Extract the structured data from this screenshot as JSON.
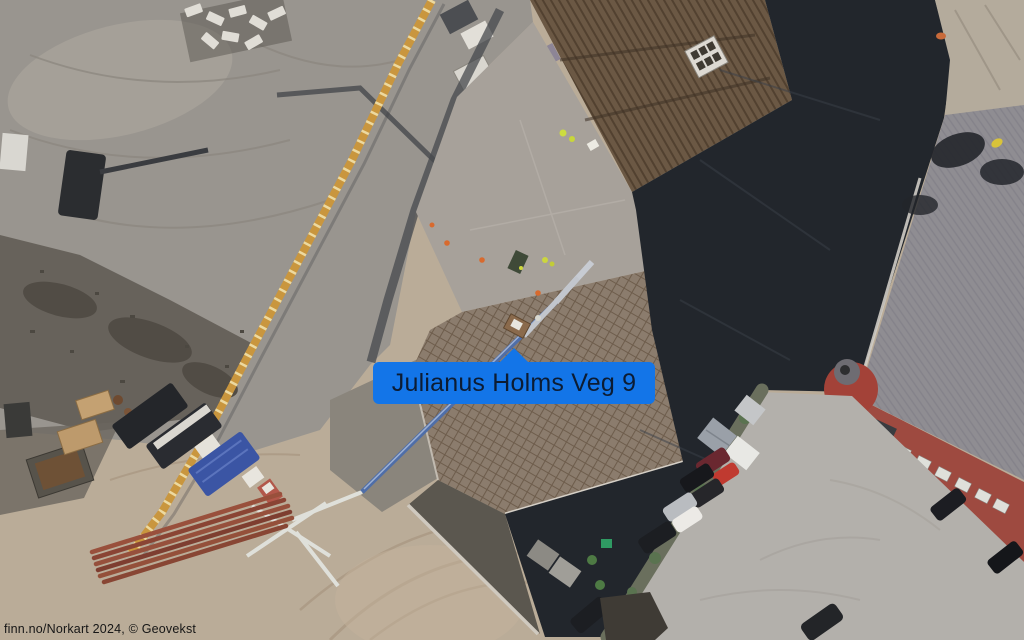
{
  "map": {
    "label": {
      "text": "Julianus Holms Veg 9",
      "bg_color": "#1375e8",
      "text_color": "#0c1c33"
    },
    "attribution": {
      "text": "finn.no/Norkart 2024, © Geovekst"
    }
  },
  "colors": {
    "dirt": "#baac98",
    "excavation": "#99958f",
    "dark_shadow": "#22262c",
    "concrete_deck": "#a7a19a",
    "rebar_deck": "#8b7c6d",
    "wood_roof": "#6b5844",
    "rock_area": "#b4ab9c",
    "red_building_wall": "#9e4a40",
    "red_building_roof": "#8f8d92",
    "parking": "#b3b0ab",
    "crane_yellow": "#c9963e",
    "pump_truck_blue": "#3b55a4",
    "steel_beams": "#96503c"
  }
}
